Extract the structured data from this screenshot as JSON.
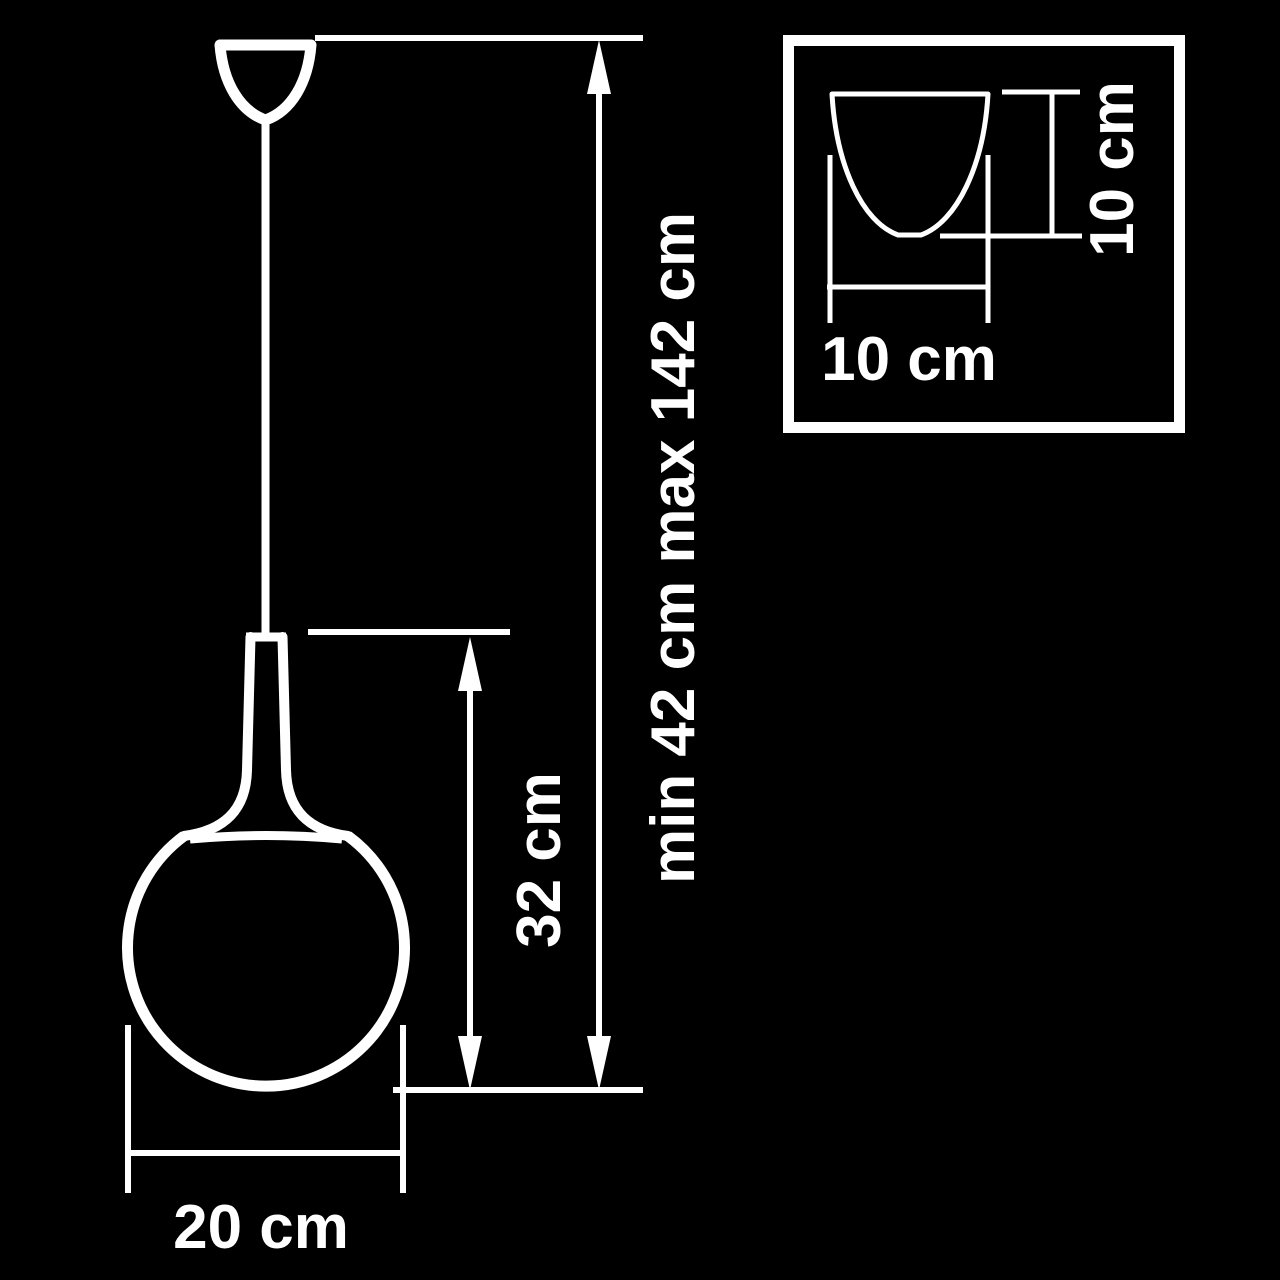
{
  "colors": {
    "background": "#000000",
    "line": "#ffffff",
    "text": "#ffffff"
  },
  "diagram": {
    "type": "pendant-lamp-dimension-drawing",
    "labels": {
      "overall_height": "min 42 cm max 142 cm",
      "body_height": "32 cm",
      "globe_diameter": "20 cm",
      "inset_width": "10 cm",
      "inset_height": "10 cm"
    }
  }
}
